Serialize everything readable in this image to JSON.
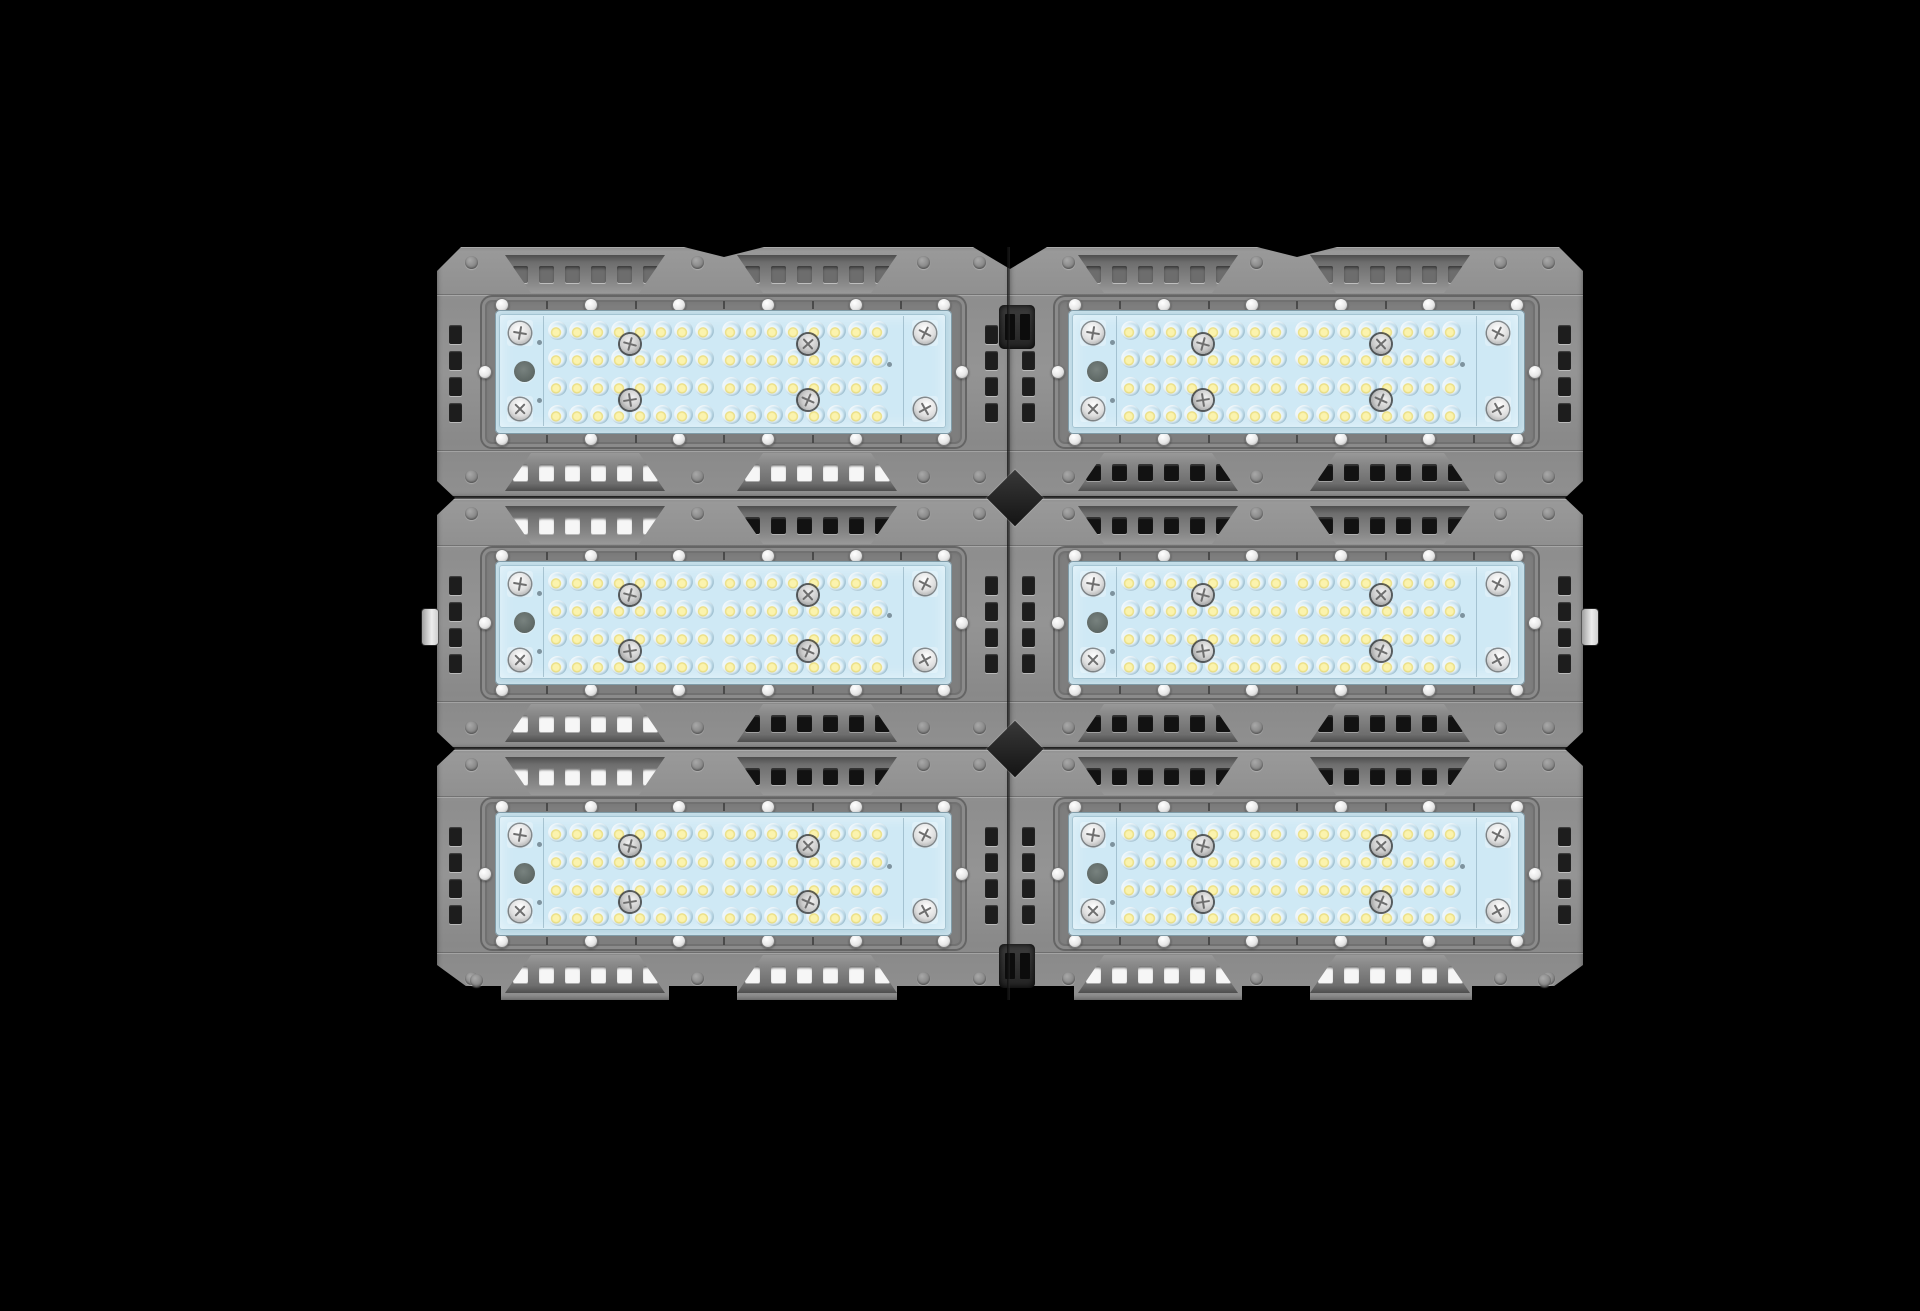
{
  "scene": {
    "type": "product-photo",
    "subject": "Modular LED flood light, front view, six LED modules on black background",
    "background": "#000000",
    "modules_grid": {
      "columns": 2,
      "rows": 3,
      "total_modules": 6
    }
  },
  "module_spec": {
    "led_rows": 4,
    "leds_per_row": 16,
    "leds_per_module": 64,
    "vent_strips": 2,
    "vents_per_strip": 2,
    "holes_per_vent": 6,
    "frame_screws": 14,
    "panel_corner_screws": 4,
    "panel_center_screws": 4,
    "side_slots_per_column": 4,
    "wiring_holes": 1
  },
  "colors": {
    "background": "#000000",
    "body": "#8f8f8f",
    "body_light": "#9b9b9b",
    "body_dark": "#6e6e6e",
    "recess": "#5a5a5a",
    "frame": "#7e7e7e",
    "frame_border": "#656565",
    "glass_rim": "#b9d7e4",
    "panel_blue": "#cfe9f5",
    "lens_blue": "#bfdcea",
    "led_yellow": "#e9dc7c",
    "screw_silver": "#e9e9e9",
    "vent_hole_light": "#f6f6f6",
    "vent_hole_dark": "#121212",
    "vent_hole_mid": "#6d6d6d",
    "seam": "#161616"
  },
  "modules": [
    {
      "id": "top-left",
      "vent_holes": {
        "top": [
          "mid",
          "mid"
        ],
        "bottom": [
          "light",
          "light"
        ]
      }
    },
    {
      "id": "top-right",
      "vent_holes": {
        "top": [
          "mid",
          "mid"
        ],
        "bottom": [
          "dark",
          "dark"
        ]
      }
    },
    {
      "id": "middle-left",
      "vent_holes": {
        "top": [
          "light",
          "dark"
        ],
        "bottom": [
          "light",
          "dark"
        ]
      }
    },
    {
      "id": "middle-right",
      "vent_holes": {
        "top": [
          "dark",
          "dark"
        ],
        "bottom": [
          "dark",
          "dark"
        ]
      }
    },
    {
      "id": "bottom-left",
      "vent_holes": {
        "top": [
          "light",
          "dark"
        ],
        "bottom": [
          "light",
          "light"
        ]
      }
    },
    {
      "id": "bottom-right",
      "vent_holes": {
        "top": [
          "dark",
          "dark"
        ],
        "bottom": [
          "light",
          "light"
        ]
      }
    }
  ]
}
